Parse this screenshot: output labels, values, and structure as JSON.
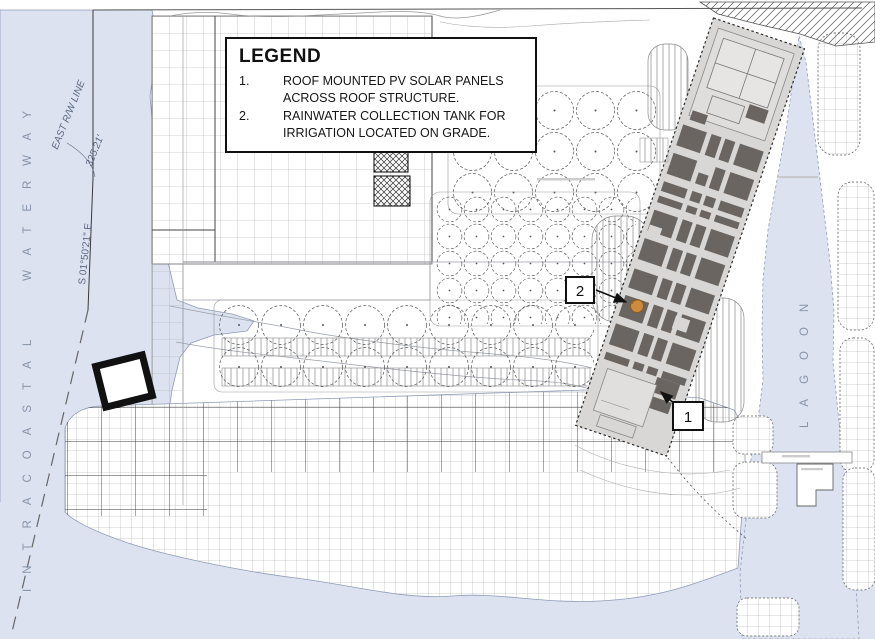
{
  "legend": {
    "title": "LEGEND",
    "items": [
      {
        "num": "1.",
        "text": "ROOF MOUNTED PV SOLAR PANELS ACROSS ROOF STRUCTURE."
      },
      {
        "num": "2.",
        "text": "RAINWATER COLLECTION TANK FOR IRRIGATION LOCATED ON GRADE."
      }
    ]
  },
  "labels": {
    "waterway": "INTRACOASTAL WATERWAY",
    "lagoon": "LAGOON",
    "rw_line": "EAST R/W LINE",
    "dimension": "325.21'",
    "bearing": "S 01°50'21\" E"
  },
  "callouts": {
    "pv": "1",
    "tank": "2"
  },
  "colors": {
    "water": "#dce2f0",
    "building_band": "#d8d7d5",
    "pv_panel": "#6a6560",
    "tank_orange": "#cd8b3e",
    "line_dark": "#111111"
  }
}
